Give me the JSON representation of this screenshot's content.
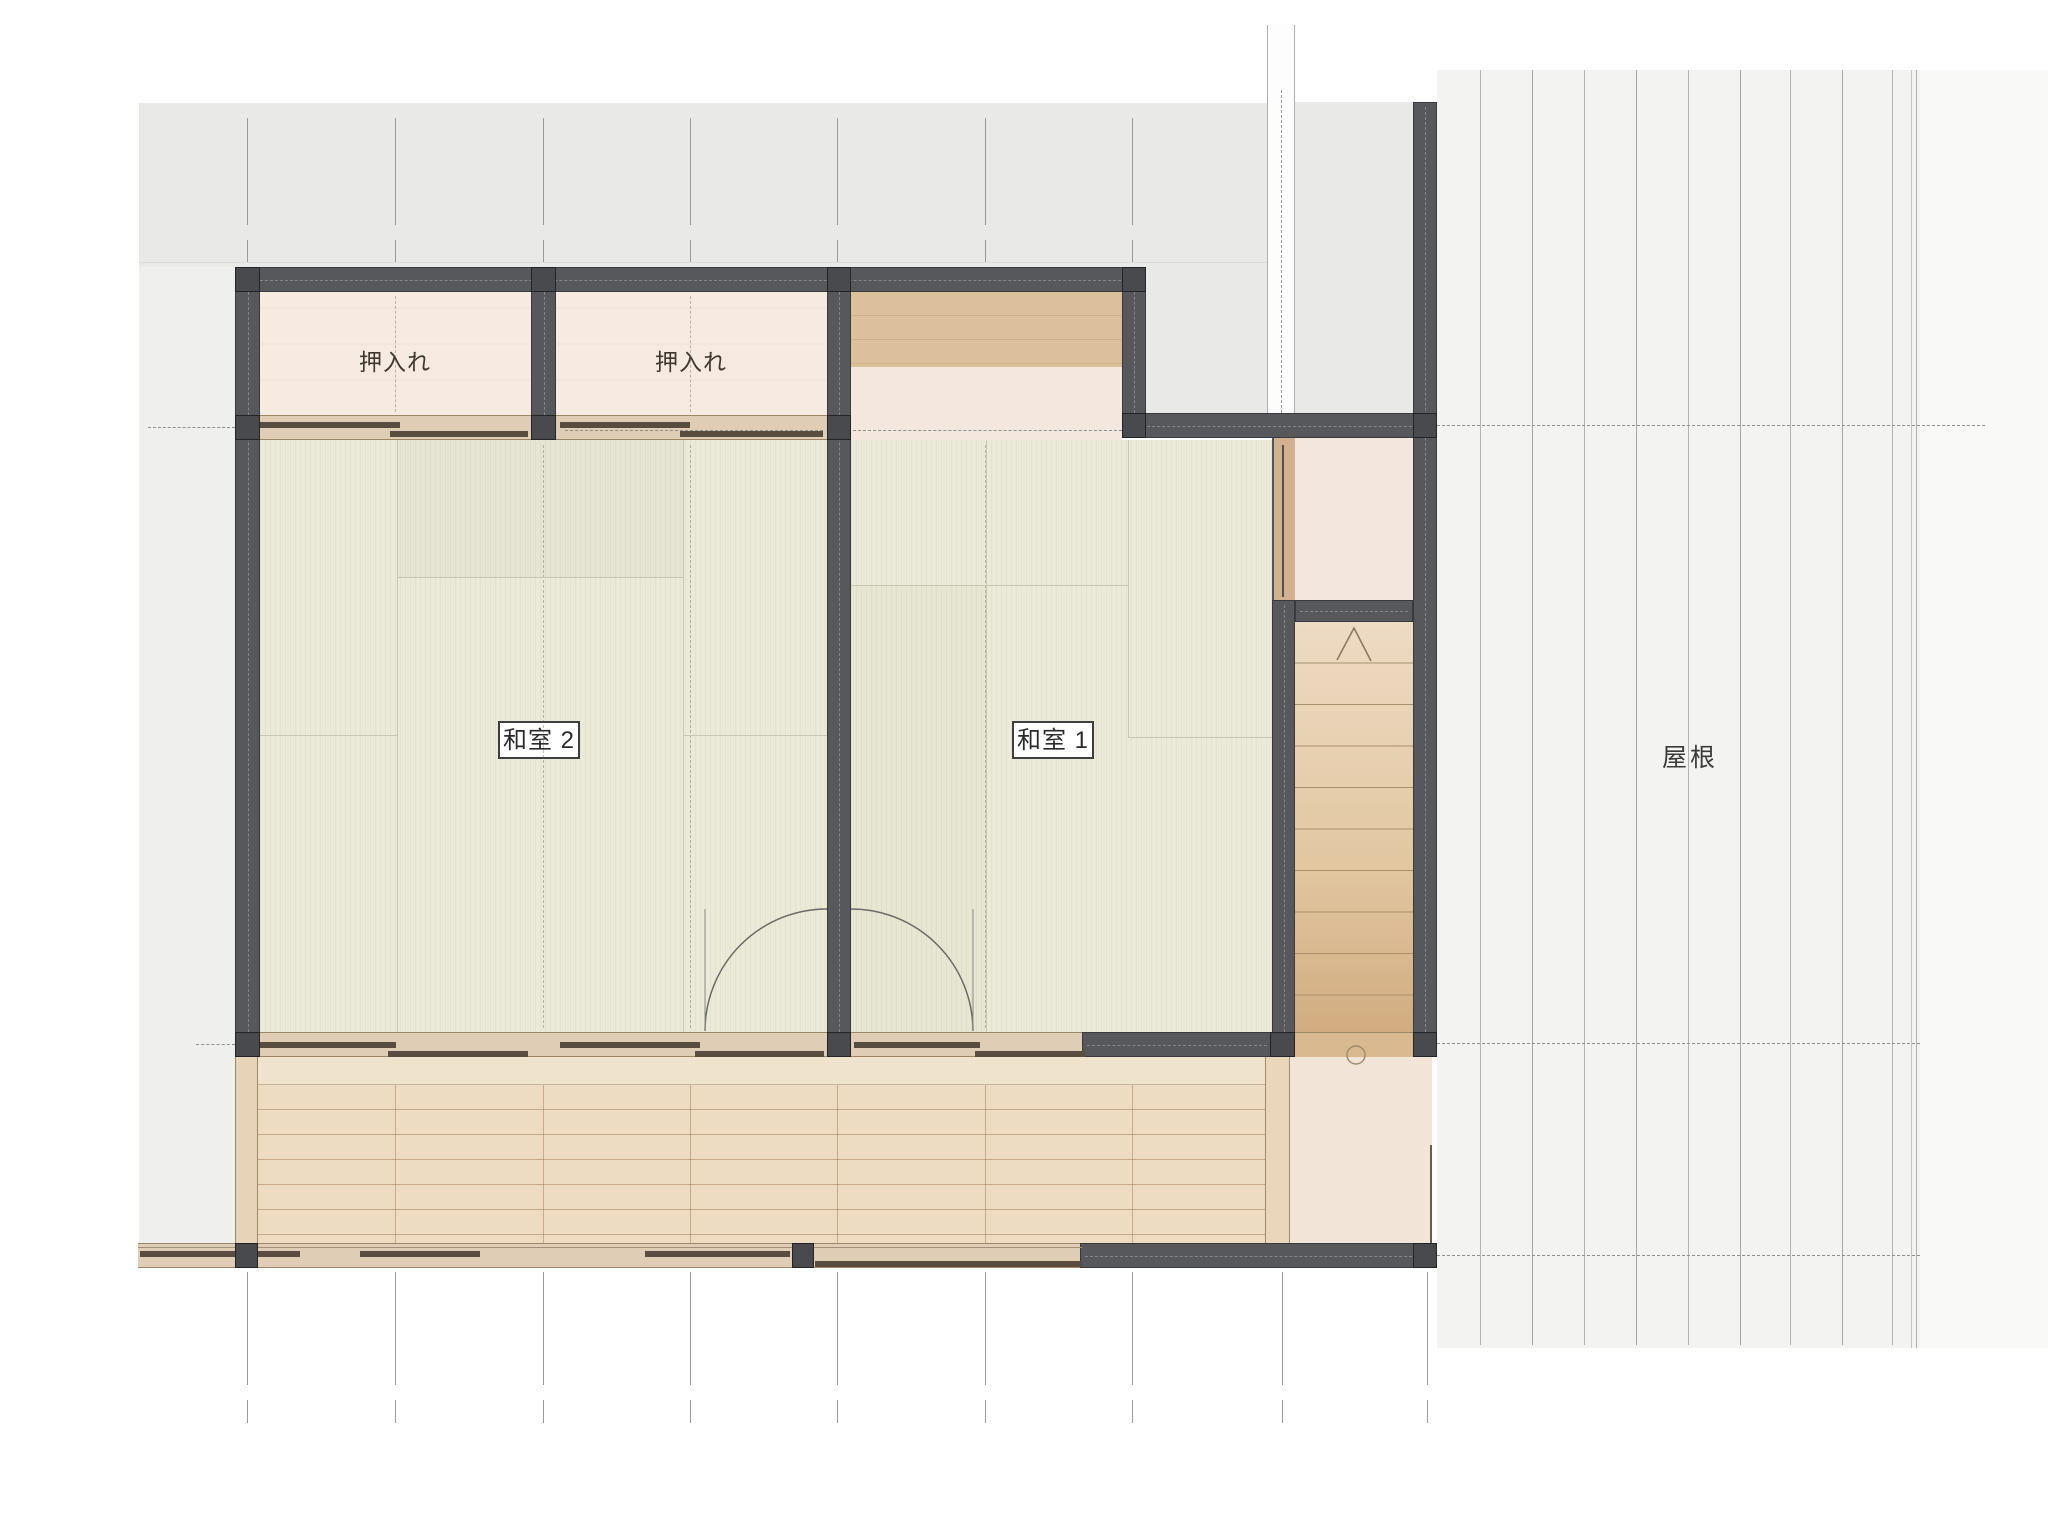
{
  "floor_plan": {
    "rooms": [
      {
        "id": "closet-left",
        "label": "押入れ"
      },
      {
        "id": "closet-right",
        "label": "押入れ"
      },
      {
        "id": "washitsu-2",
        "label": "和室 2"
      },
      {
        "id": "washitsu-1",
        "label": "和室 1"
      }
    ],
    "roof_label": "屋根",
    "stairs": {
      "visible_treads": 10,
      "up_symbol": "∧"
    },
    "palette": {
      "wall": "#57585c",
      "tatami": "#ebead9",
      "closet_floor": "#f6eae1",
      "wood_floor": "#dcc09c",
      "deck": "#eddcc1",
      "stair_tread": "#e0c6a0",
      "porch": "#f3e4d8",
      "roof_gray": "#e9e9e8",
      "roof_light": "#f3f3f2",
      "door_track": "#584d3f"
    }
  }
}
